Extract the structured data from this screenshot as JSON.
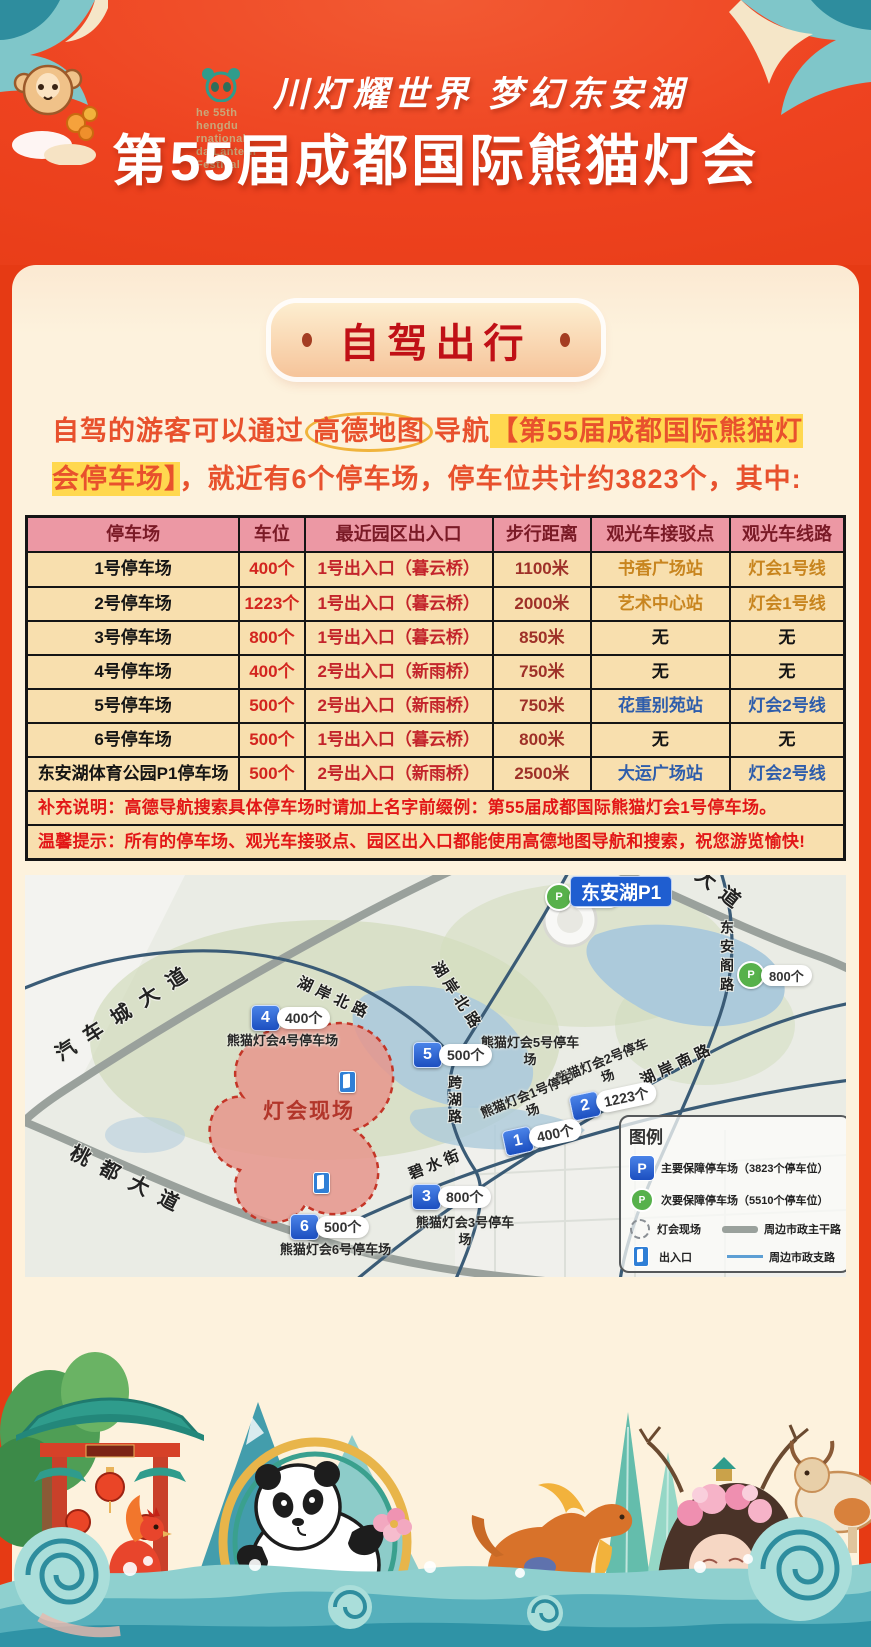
{
  "colors": {
    "header_red": "#ee4320",
    "panel_cream": "#fdf2dd",
    "badge_text_red": "#c01016",
    "intro_orange": "#e8512d",
    "highlight_yellow": "#ffd84f",
    "table_header_pink": "#ec98a4",
    "table_row_tan": "#f8dfae",
    "marker_blue": "#1d5ed2",
    "marker_green": "#57b14b",
    "site_pink": "#e6958c"
  },
  "header": {
    "logo_lines": [
      "he 55th",
      "hengdu",
      "rnational",
      "da Lantern",
      "Festival"
    ],
    "slogan": "川灯耀世界 梦幻东安湖",
    "title": "第55届成都国际熊猫灯会"
  },
  "section": {
    "badge_label": "自驾出行"
  },
  "intro": {
    "pre": "自驾的游客可以通过",
    "circled": "高德地图",
    "mid": "导航",
    "highlight": "【第55届成都国际熊猫灯会停车场】",
    "post": "，就近有6个停车场，停车位共计约3823个，其中:"
  },
  "table": {
    "headers": [
      "停车场",
      "车位",
      "最近园区出入口",
      "步行距离",
      "观光车接驳点",
      "观光车线路"
    ],
    "rows": [
      {
        "name": "1号停车场",
        "spots": "400个",
        "gate": "1号出入口（暮云桥）",
        "distance": "1100米",
        "stop": "书香广场站",
        "line": "灯会1号线"
      },
      {
        "name": "2号停车场",
        "spots": "1223个",
        "gate": "1号出入口（暮云桥）",
        "distance": "2000米",
        "stop": "艺术中心站",
        "line": "灯会1号线"
      },
      {
        "name": "3号停车场",
        "spots": "800个",
        "gate": "1号出入口（暮云桥）",
        "distance": "850米",
        "stop": "无",
        "line": "无"
      },
      {
        "name": "4号停车场",
        "spots": "400个",
        "gate": "2号出入口（新雨桥）",
        "distance": "750米",
        "stop": "无",
        "line": "无"
      },
      {
        "name": "5号停车场",
        "spots": "500个",
        "gate": "2号出入口（新雨桥）",
        "distance": "750米",
        "stop": "花重别苑站",
        "line": "灯会2号线"
      },
      {
        "name": "6号停车场",
        "spots": "500个",
        "gate": "1号出入口（暮云桥）",
        "distance": "800米",
        "stop": "无",
        "line": "无"
      },
      {
        "name": "东安湖体育公园P1停车场",
        "spots": "500个",
        "gate": "2号出入口（新雨桥）",
        "distance": "2500米",
        "stop": "大运广场站",
        "line": "灯会2号线"
      }
    ],
    "note_supplement": "补充说明：高德导航搜索具体停车场时请加上名字前缀例：第55届成都国际熊猫灯会1号停车场。",
    "note_tip": "温馨提示：所有的停车场、观光车接驳点、园区出入口都能使用高德地图导航和搜索，祝您游览愉快!"
  },
  "map": {
    "p1_badge": "东安湖P1",
    "site_label": "灯会现场",
    "green_markers": [
      {
        "p": "P",
        "count": "479个"
      },
      {
        "p": "P",
        "count": "800个"
      }
    ],
    "markers": [
      {
        "num": "1",
        "count": "400个",
        "name": "熊猫灯会1号停车场"
      },
      {
        "num": "2",
        "count": "1223个",
        "name": "熊猫灯会2号停车场"
      },
      {
        "num": "3",
        "count": "800个",
        "name": "熊猫灯会3号停车场"
      },
      {
        "num": "4",
        "count": "400个",
        "name": "熊猫灯会4号停车场"
      },
      {
        "num": "5",
        "count": "500个",
        "name": "熊猫灯会5号停车场"
      },
      {
        "num": "6",
        "count": "500个",
        "name": "熊猫灯会6号停车场"
      }
    ],
    "roads": {
      "qichecheng": "汽车城大道",
      "taodu": "桃都大道",
      "dadao": "大道",
      "dongange": "东安阁路",
      "huan_north_a": "湖岸北路",
      "huan_north_b": "湖岸北路",
      "huan_south": "湖岸南路",
      "bishui": "碧水街",
      "kuahu": "跨湖路"
    },
    "legend": {
      "title": "图例",
      "p_main": "P",
      "p_secondary": "P",
      "main_parking": "主要保障停车场（3823个停车位）",
      "secondary_parking": "次要保障停车场（5510个停车位）",
      "site": "灯会现场",
      "main_road": "周边市政主干路",
      "entrance": "出入口",
      "support_road": "周边市政支路"
    }
  }
}
